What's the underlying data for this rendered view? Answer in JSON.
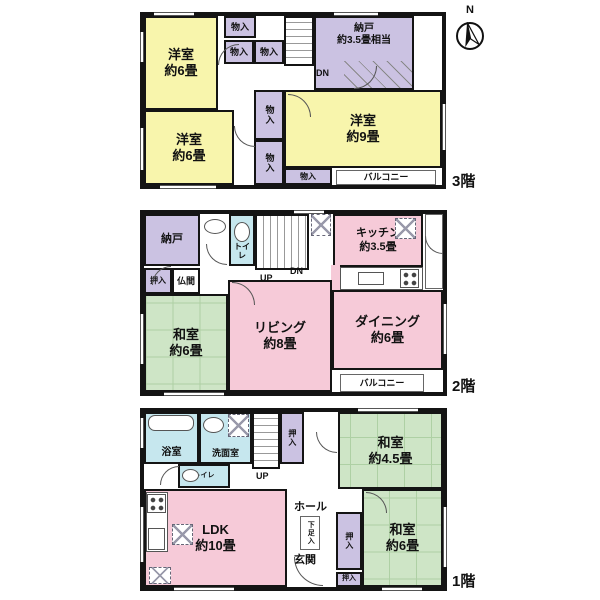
{
  "compass": {
    "north": "N"
  },
  "colors": {
    "yellow": "#F8F5AC",
    "purple": "#CBC2E2",
    "pink": "#F6CAD8",
    "green": "#CEE5C6",
    "blue": "#C6E7EE",
    "wall": "#141414"
  },
  "floor3": {
    "floor_label": "3階",
    "rooms": {
      "west_room_a": "洋室\n約6畳",
      "west_room_b": "洋室\n約6畳",
      "west_room_large": "洋室\n約9畳",
      "storage": "納戸\n約3.5畳相当",
      "closet_top": "物入",
      "closet_left": "物入",
      "closet_right": "物入",
      "closet_mid_upper": "物入",
      "closet_mid_lower": "物入",
      "closet_bottom": "物入",
      "balcony": "バルコニー",
      "stairs_down": "DN"
    }
  },
  "floor2": {
    "floor_label": "2階",
    "rooms": {
      "storage": "納戸",
      "toilet": "トイレ",
      "stairs_up": "UP",
      "stairs_down": "DN",
      "kitchen": "キッチン\n約3.5畳",
      "closet": "押入",
      "altar_room": "仏間",
      "japanese_room": "和室\n約6畳",
      "living": "リビング\n約8畳",
      "dining": "ダイニング\n約6畳",
      "balcony": "バルコニー"
    }
  },
  "floor1": {
    "floor_label": "1階",
    "rooms": {
      "bathroom": "浴室",
      "washroom": "洗面室",
      "toilet": "トイレ",
      "stairs_up": "UP",
      "closet_top": "押入",
      "japanese_room_small": "和室\n約4.5畳",
      "ldk": "LDK\n約10畳",
      "hall": "ホール",
      "entrance": "玄関",
      "shoe_closet": "下足入",
      "closet_side": "押入",
      "closet_bottom": "押入",
      "japanese_room": "和室\n約6畳"
    }
  }
}
